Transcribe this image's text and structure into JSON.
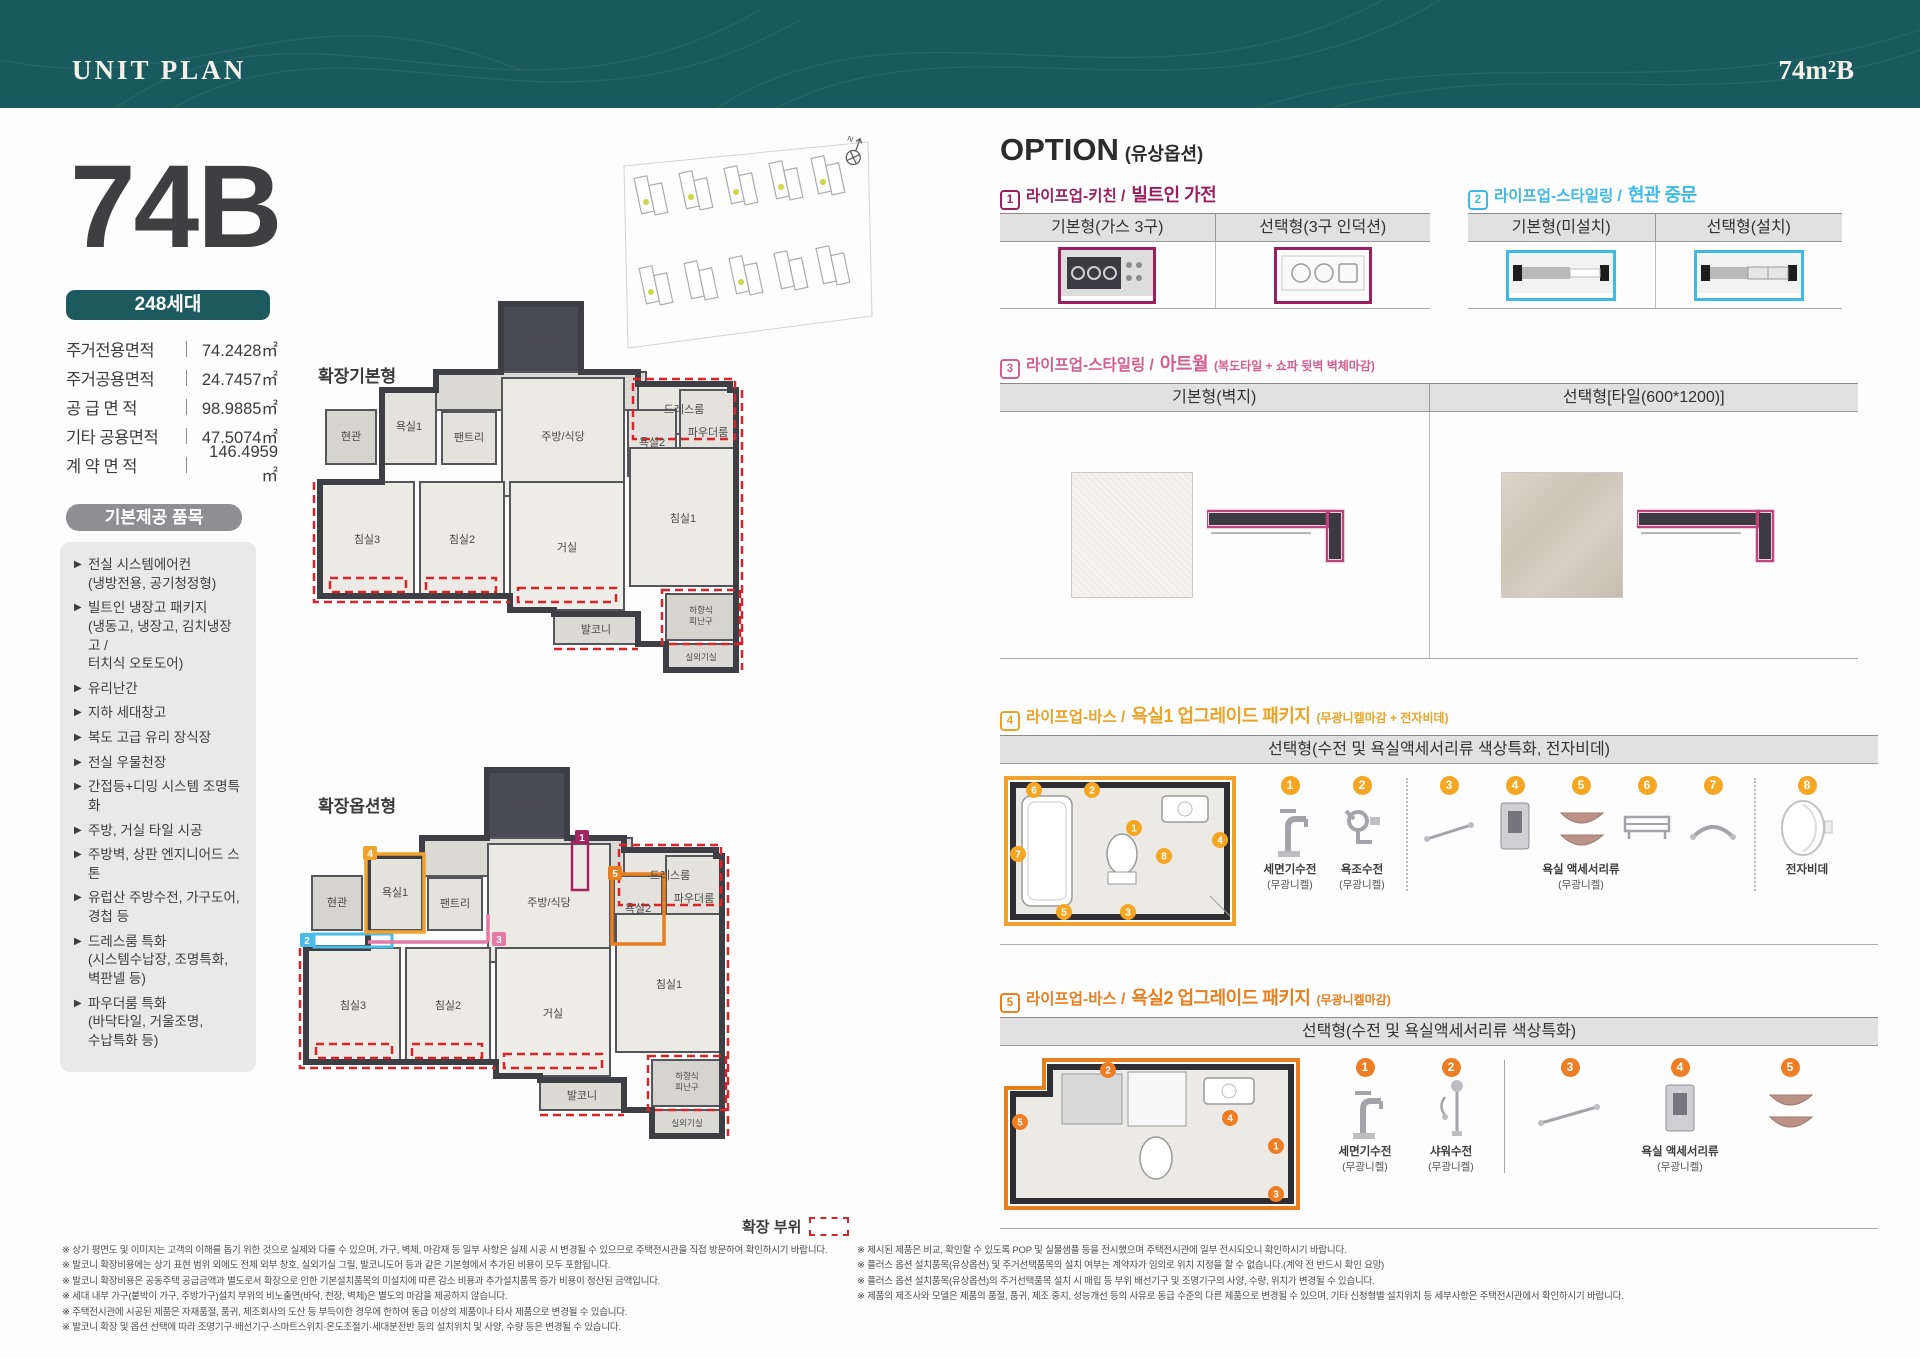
{
  "header": {
    "title": "UNIT PLAN",
    "unit_code": "74m²B"
  },
  "unit": {
    "name": "74B",
    "households": "248세대",
    "areas": [
      {
        "label": "주거전용면적",
        "value": "74.2428㎡"
      },
      {
        "label": "주거공용면적",
        "value": "24.7457㎡"
      },
      {
        "label": "공 급 면 적",
        "value": "98.9885㎡"
      },
      {
        "label": "기타 공용면적",
        "value": "47.5074㎡"
      },
      {
        "label": "계 약 면 적",
        "value": "146.4959㎡"
      }
    ]
  },
  "base_items": {
    "title": "기본제공 품목",
    "bullet": "▶",
    "items": [
      "전실 시스템에어컨\n(냉방전용, 공기청정형)",
      "빌트인 냉장고 패키지\n(냉동고, 냉장고, 김치냉장고 /\n터치식 오토도어)",
      "유리난간",
      "지하 세대창고",
      "복도 고급 유리 장식장",
      "전실 우물천장",
      "간접등+디밍 시스템 조명특화",
      "주방, 거실 타일 시공",
      "주방벽, 상판 엔지니어드 스톤",
      "유럽산 주방수전, 가구도어,\n경첩 등",
      "드레스룸 특화\n(시스템수납장, 조명특화,\n벽판넬 등)",
      "파우더룸 특화\n(바닥타일, 거울조명,\n수납특화 등)"
    ]
  },
  "plans": {
    "plan1_label": "확장기본형",
    "plan2_label": "확장옵션형",
    "legend_label": "확장 부위",
    "compass": "N",
    "rooms": {
      "utility": "다용도실",
      "dress": "드레스룸",
      "entry": "현관",
      "bath1": "욕실1",
      "pantry": "팬트리",
      "kitchen": "주방/식당",
      "bath2": "욕실2",
      "powder": "파우더룸",
      "bed3": "침실3",
      "bed2": "침실2",
      "living": "거실",
      "bed1": "침실1",
      "balcony": "발코니",
      "escape1": "하향식",
      "escape2": "피난구",
      "outdoor": "실외기실"
    }
  },
  "options": {
    "title": "OPTION",
    "subtitle": "(유상옵션)",
    "opt1": {
      "num": "1",
      "prefix": "라이프업-키친 /",
      "name": "빌트인 가전",
      "col1": "기본형(가스 3구)",
      "col2": "선택형(3구 인덕션)"
    },
    "opt2": {
      "num": "2",
      "prefix": "라이프업-스타일링 /",
      "name": "현관 중문",
      "col1": "기본형(미설치)",
      "col2": "선택형(설치)"
    },
    "opt3": {
      "num": "3",
      "prefix": "라이프업-스타일링 /",
      "name": "아트월",
      "note": "(복도타일 + 쇼파 뒷벽 벽체마감)",
      "col1": "기본형(벽지)",
      "col2": "선택형[타일(600*1200)]"
    },
    "opt4": {
      "num": "4",
      "prefix": "라이프업-바스 /",
      "name": "욕실1 업그레이드 패키지",
      "note": "(무광니켈마감 + 전자비데)",
      "col": "선택형(수전 및 욕실액세서리류 색상특화, 전자비데)",
      "markers": [
        "1",
        "2",
        "3",
        "4",
        "5",
        "6",
        "7",
        "8"
      ],
      "captions": {
        "f1": "세면기수전",
        "f1s": "(무광니켈)",
        "f2": "욕조수전",
        "f2s": "(무광니켈)",
        "group": "욕실 액세서리류",
        "groups": "(무광니켈)",
        "f8": "전자비데"
      }
    },
    "opt5": {
      "num": "5",
      "prefix": "라이프업-바스 /",
      "name": "욕실2 업그레이드 패키지",
      "note": "(무광니켈마감)",
      "col": "선택형(수전 및 욕실액세서리류 색상특화)",
      "markers": [
        "1",
        "2",
        "3",
        "4",
        "5"
      ],
      "captions": {
        "f1": "세면기수전",
        "f1s": "(무광니켈)",
        "f2": "샤워수전",
        "f2s": "(무광니켈)",
        "group": "욕실 액세서리류",
        "groups": "(무광니켈)"
      }
    }
  },
  "footnotes_left": [
    "※ 상기 평면도 및 이미지는 고객의 이해를 돕기 위한 것으로 실제와 다를 수 있으며, 가구, 벽체, 마감재 등 일부 사항은 실제 시공 시 변경될 수 있으므로 주택전시관을 직접 방문하여 확인하시기 바랍니다.",
    "※ 발코니 확장비용에는 상기 표현 범위 외에도 전체 외부 창호, 실외기실 그릴, 발코니도어 등과 같은 기본형에서 추가된 비용이 모두 포함됩니다.",
    "※ 발코니 확장비용은 공동주택 공급금액과 별도로서 확장으로 인한 기본설치품목의 미설치에 따른 감소 비용과 추가설치품목 증가 비용이 정산된 금액입니다.",
    "※ 세대 내부 가구(붙박이 가구, 주방가구)설치 부위의 비노출면(바닥, 천장, 벽체)은 별도의 마감을 제공하지 않습니다.",
    "※ 주택전시관에 시공된 제품은 자재품절, 품귀, 제조회사의 도산 등 부득이한 경우에 한하여 동급 이상의 제품이나 타사 제품으로 변경될 수 있습니다.",
    "※ 발코니 확장 및 옵션 선택에 따라 조명기구·배선기구·스마트스위치·온도조절기·세대분전반 등의 설치위치 및 사양, 수량 등은 변경될 수 있습니다."
  ],
  "footnotes_right": [
    "※ 제시된 제품은 비교, 확인할 수 있도록 POP 및 실물샘플 등을 전시했으며 주택전시관에 일부 전시되오니 확인하시기 바랍니다.",
    "※ 플러스 옵션 설치품목(유상옵션) 및 주거선택품목의 설치 여부는 계약자가 임의로 위치 지정을 할 수 없습니다.(계약 전 반드시 확인 요망)",
    "※ 플러스 옵션 설치품목(유상옵션)의 주거선택품목 설치 시 매립 등 부위 배선기구 및 조명기구의 사양, 수량, 위치가 변경될 수 있습니다.",
    "※ 제품의 제조사와 모델은 제품의 품절, 품귀, 제조 중지, 성능개선 등의 사유로 동급 수준의 다른 제품으로 변경될 수 있으며, 기타 신청형별 설치위치 등 세부사항은 주택전시관에서 확인하시기 바랍니다."
  ]
}
